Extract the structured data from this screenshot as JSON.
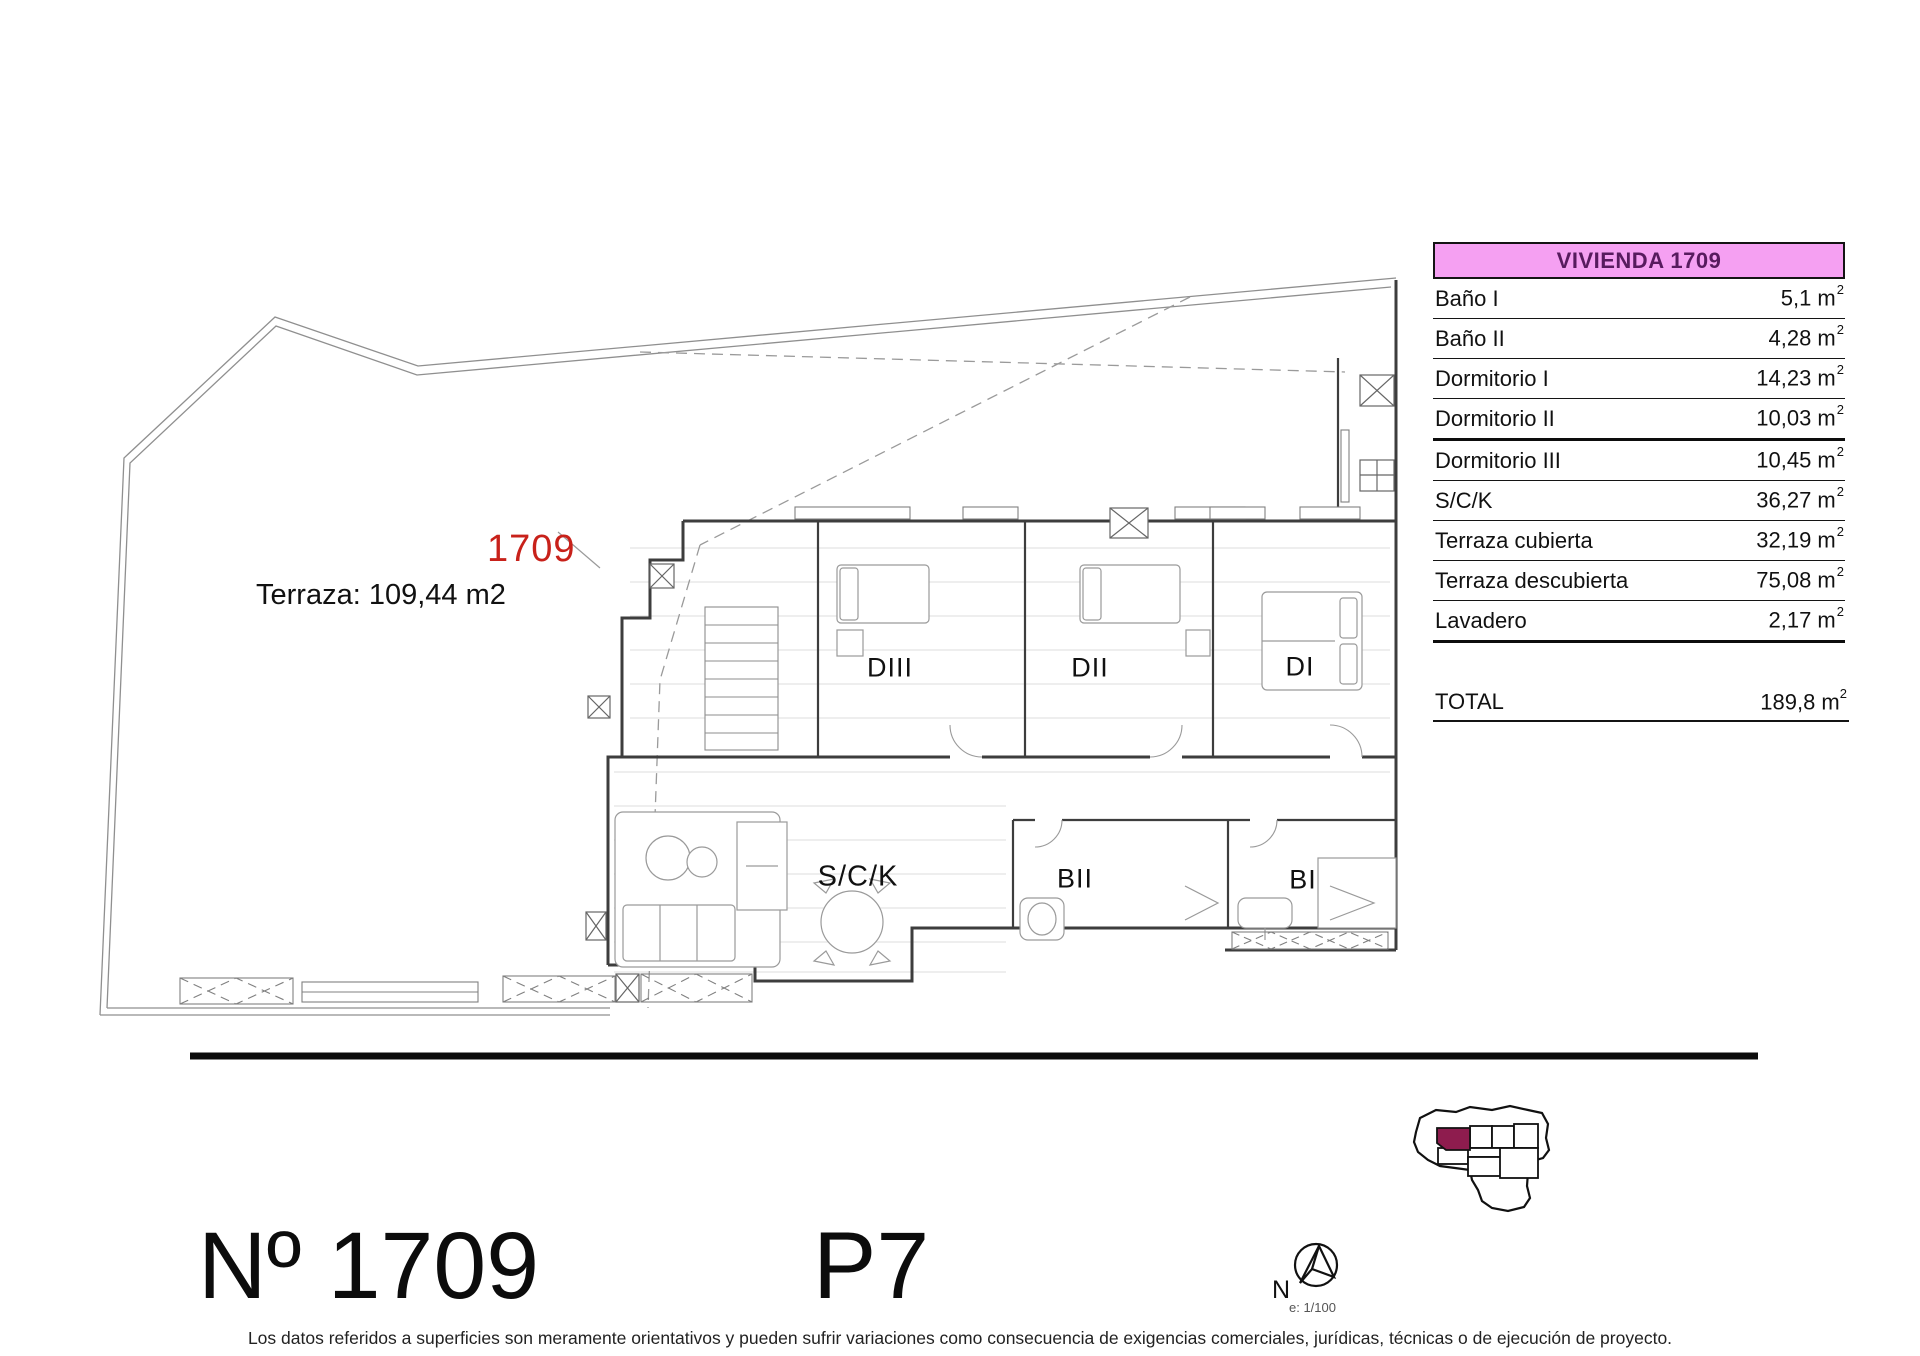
{
  "plan": {
    "unit_id": "1709",
    "terrace_note": "Terraza: 109,44 m2",
    "rooms": {
      "diii": "DIII",
      "dii": "DII",
      "di": "DI",
      "sck": "S/C/K",
      "bii": "BII",
      "bi": "BI"
    }
  },
  "table": {
    "title": "VIVIENDA 1709",
    "unit": " m",
    "unit_sup": "2",
    "rows": [
      {
        "label": "Baño I",
        "value": "5,1"
      },
      {
        "label": "Baño II",
        "value": "4,28"
      },
      {
        "label": "Dormitorio I",
        "value": "14,23"
      },
      {
        "label": "Dormitorio II",
        "value": "10,03"
      },
      {
        "label": "Dormitorio III",
        "value": "10,45"
      },
      {
        "label": "S/C/K",
        "value": "36,27"
      },
      {
        "label": "Terraza cubierta",
        "value": "32,19"
      },
      {
        "label": "Terraza descubierta",
        "value": "75,08"
      },
      {
        "label": "Lavadero",
        "value": "2,17"
      }
    ],
    "total": {
      "label": "TOTAL",
      "value": "189,8"
    }
  },
  "sheet": {
    "number": "Nº 1709",
    "floor": "P7",
    "footer": "Los datos referidos a superficies son meramente orientativos y pueden sufrir variaciones como consecuencia de exigencias comerciales, jurídicas, técnicas o de ejecución de proyecto."
  },
  "compass": {
    "north": "N",
    "scale": "e: 1/100"
  },
  "colors": {
    "table_header_bg": "#F5A0F2",
    "table_header_text": "#571B5E",
    "unit_id_red": "#C8211A",
    "keyplan_highlight": "#8E1C4E"
  }
}
